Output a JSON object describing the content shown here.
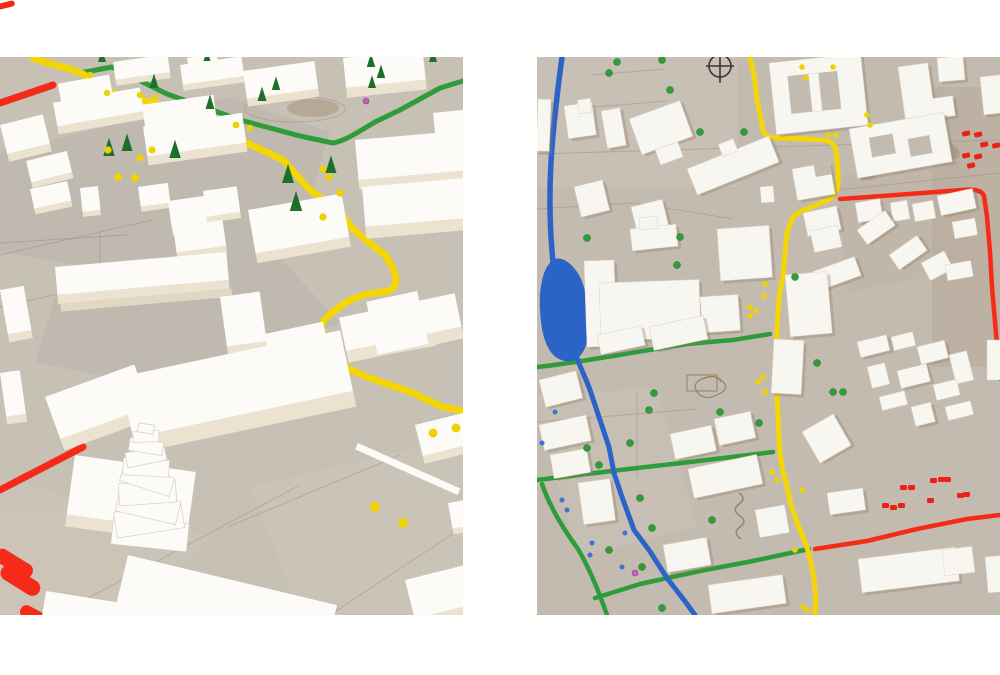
{
  "page": {
    "title": "Architectural massing model — photo pair",
    "background": "#ffffff"
  },
  "colors": {
    "board_left": "#c7c0b5",
    "board_right": "#c4bbb0",
    "board_patch": "#b3afa9",
    "board_patch_warm": "#cfc7b9",
    "bld_top": "#fcfbf7",
    "bld_side": "#ece2d0",
    "bld_shadow": "#a59d90",
    "bld_top_right": "#f8f6f1",
    "bld_shadow_right": "#8f7d66",
    "road_yellow": "#f4d505",
    "road_green": "#2f9b3a",
    "road_red": "#f52a19",
    "road_blue": "#2c63c7",
    "tree_dark": "#1e6f2b",
    "tree_bright": "#2f9e36",
    "dot_yellow": "#eed203",
    "dot_blue": "#3f73d2",
    "dot_pink": "#c95fb8",
    "car_red": "#ee1f14",
    "pencil": "#9a9184",
    "scribble": "#8a6f46",
    "compass": "#3b352d"
  },
  "photos": {
    "left": {
      "alt": "Oblique photo of a white architectural massing model: foam buildings on grey cardboard, a winding yellow plasticine road, a green road, red road pieces, dark green conifer trees, yellow dots and a stepped spiral tower",
      "view": "perspective"
    },
    "right": {
      "alt": "Top-down photo of a white architectural massing model: blue river and pond, yellow, green and red plasticine roads, a compass mark, scattered round trees, yellow dots and small red cars",
      "view": "top-down"
    }
  }
}
